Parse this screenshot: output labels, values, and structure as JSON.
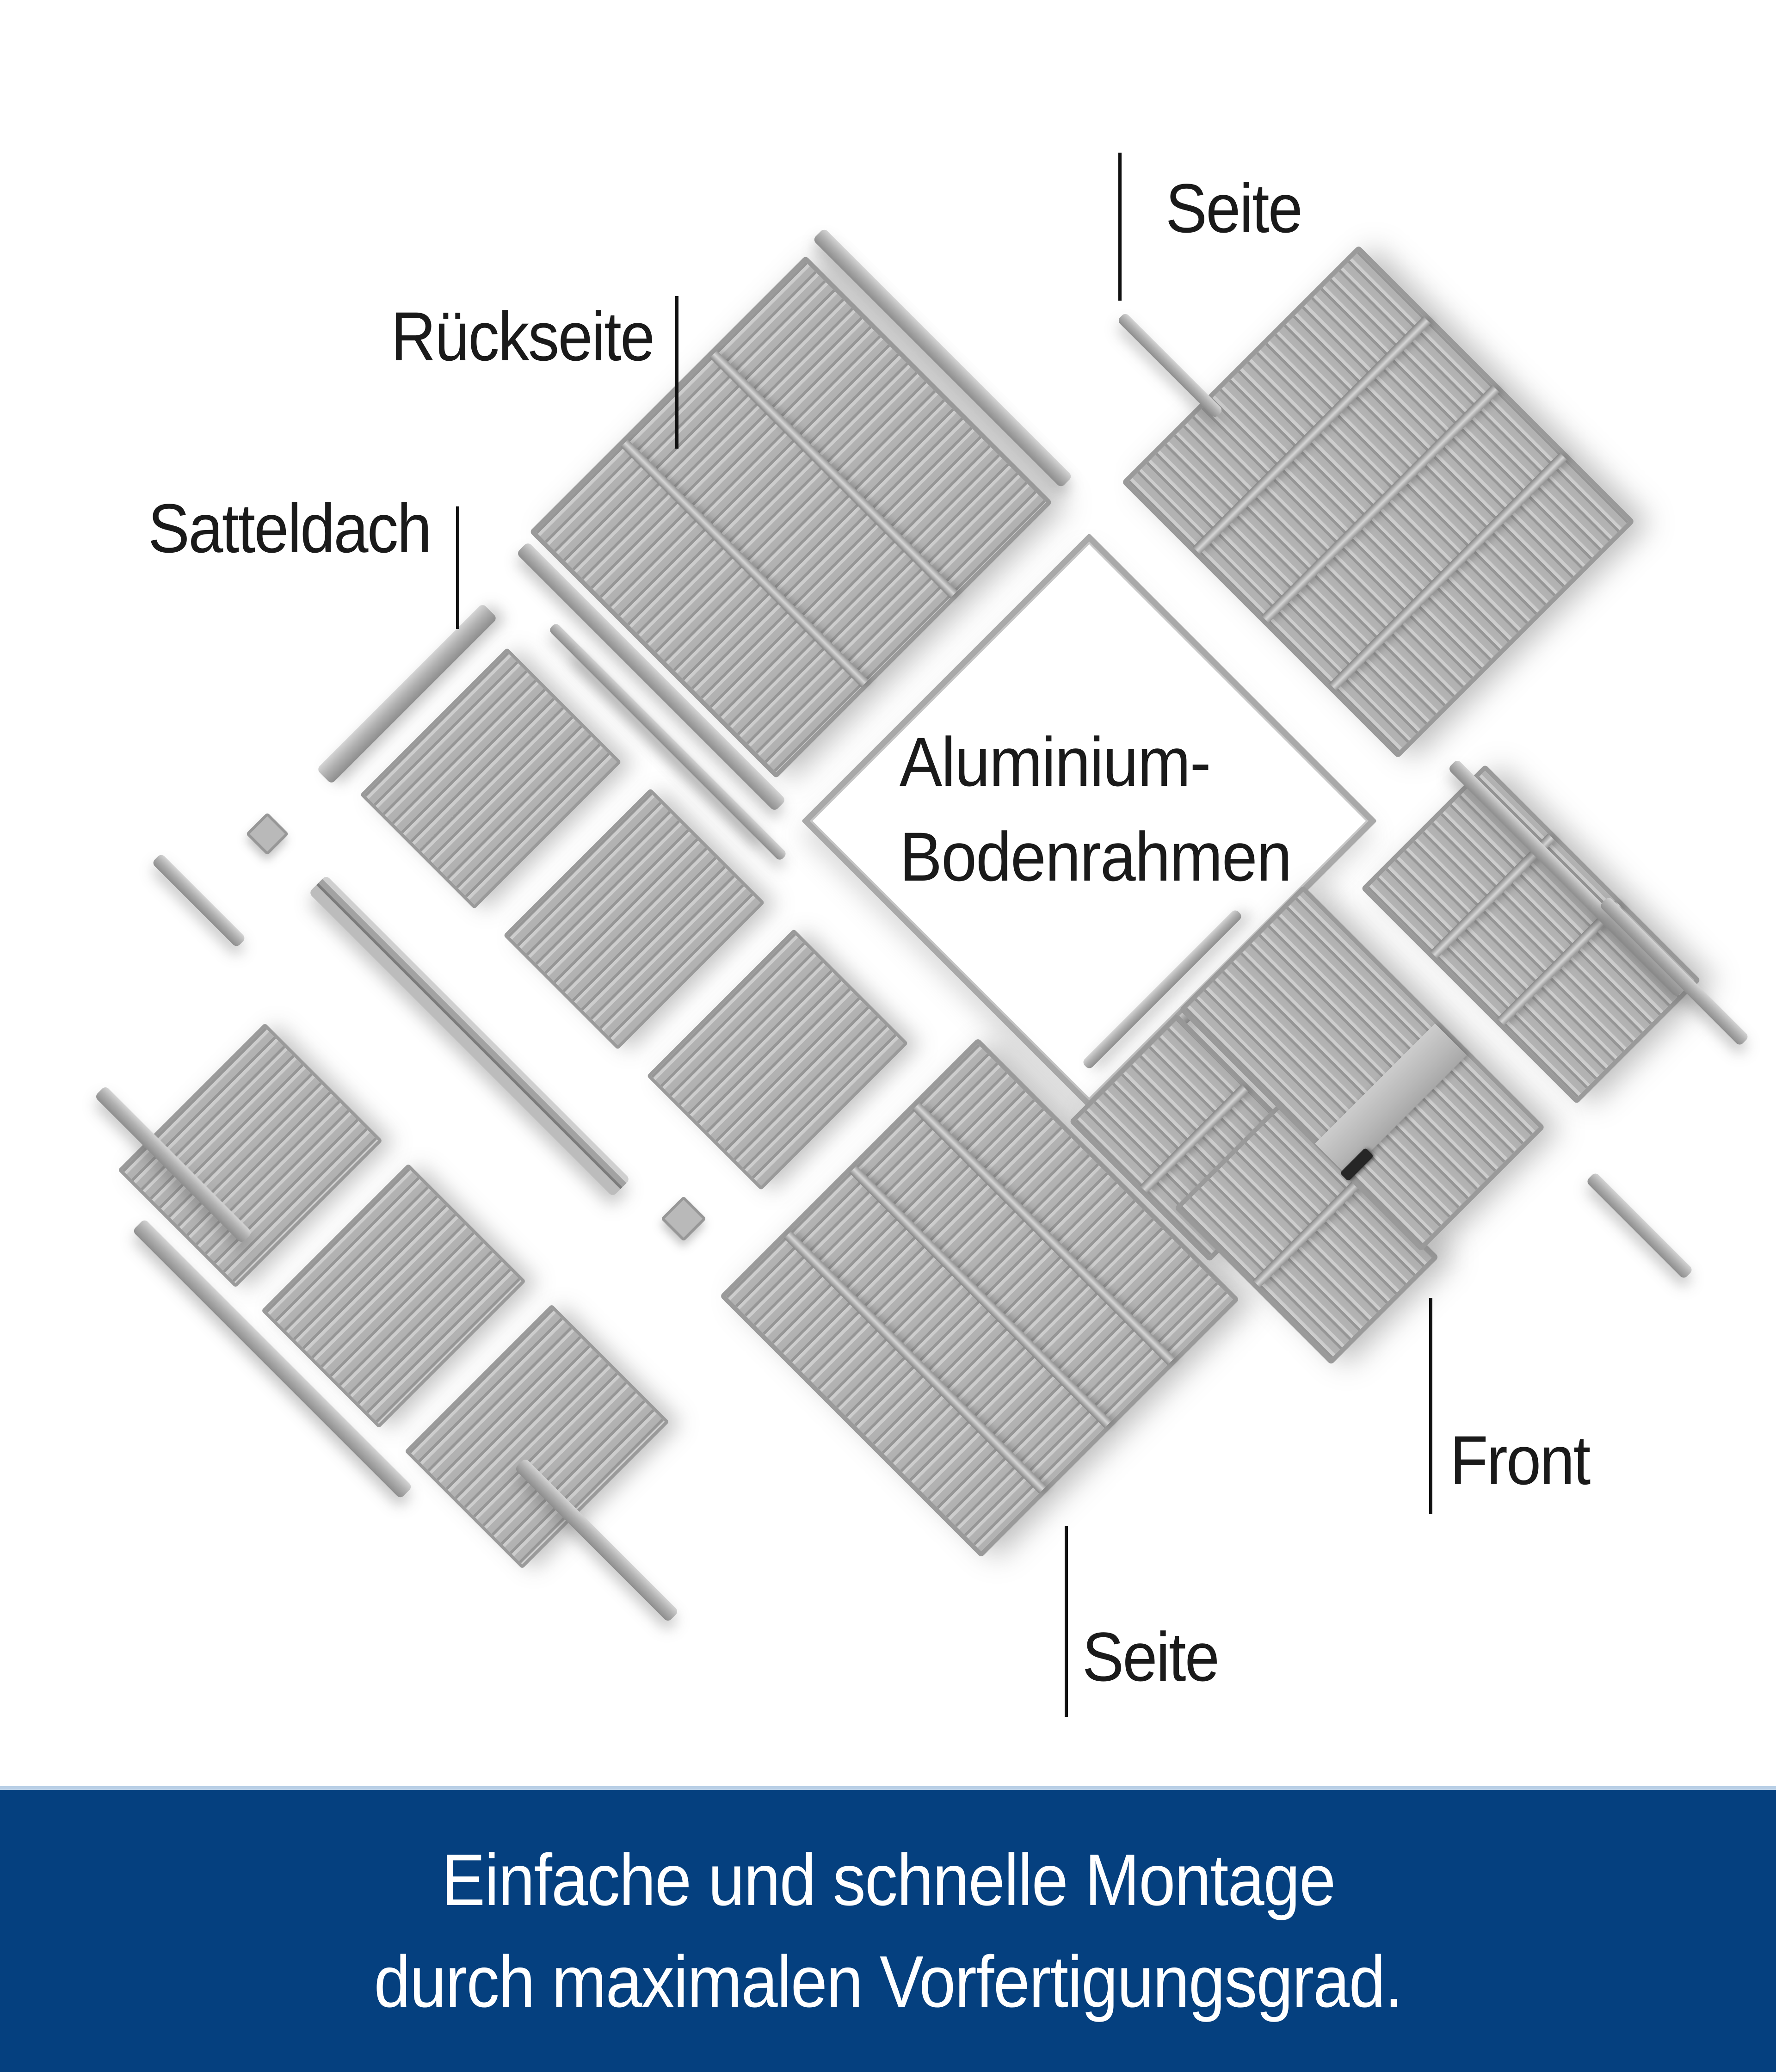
{
  "colors": {
    "page_bg": "#ffffff",
    "label_text": "#1a1a1a",
    "callout_line": "#111111",
    "banner_bg": "#05407f",
    "banner_border": "#b9cfe6",
    "banner_text": "#ffffff",
    "panel_frame": "#9a9a9a",
    "panel_base": "#b3b3b3"
  },
  "diagram": {
    "labels": {
      "seite_top": "Seite",
      "rueckseite": "Rückseite",
      "satteldach": "Satteldach",
      "bodenrahmen_line1": "Aluminium-",
      "bodenrahmen_line2": "Bodenrahmen",
      "front": "Front",
      "seite_bottom": "Seite"
    }
  },
  "banner": {
    "line1": "Einfache und schnelle Montage",
    "line2": "durch maximalen Vorfertigungsgrad."
  }
}
